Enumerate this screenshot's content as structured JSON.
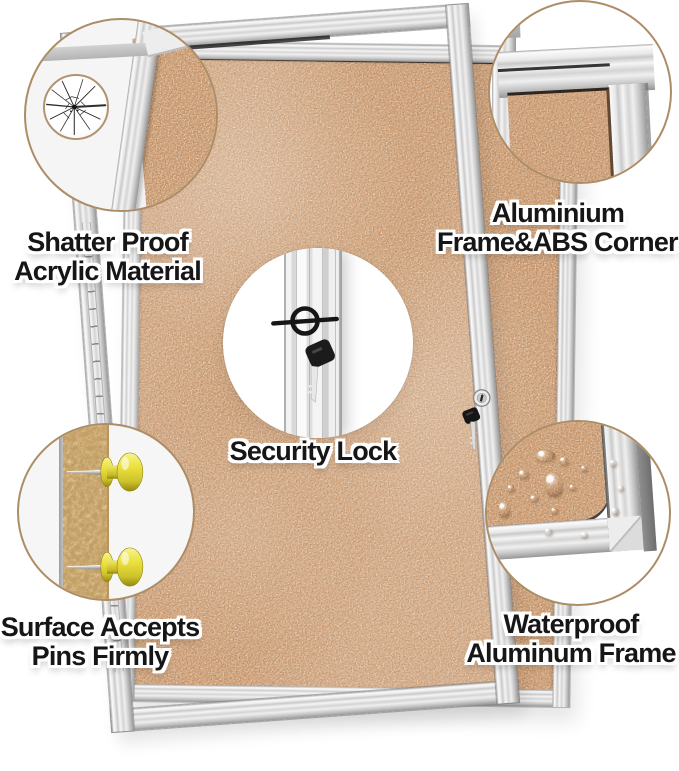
{
  "image_type": "product-feature-callout-diagram",
  "product": "Enclosed cork bulletin board with lockable acrylic door",
  "colors": {
    "background": "#ffffff",
    "cork": "#c28b5e",
    "cork_crumb": "#dab376",
    "frame_silver": "#e9e9e9",
    "circle_ring": "#ac8d65",
    "seam": "#1f1f1f",
    "pin_yellow": "#e9e34a",
    "text": "#161616",
    "text_outline": "#ffffff"
  },
  "callouts": [
    {
      "id": "shatterproof",
      "icon": "cracked-glass",
      "lines": [
        "Shatter Proof",
        "Acrylic Material"
      ]
    },
    {
      "id": "aluminium-corners",
      "icon": "frame-corner",
      "lines": [
        "Aluminium",
        "Frame&ABS Corners"
      ]
    },
    {
      "id": "security-lock",
      "icon": "lock-and-key",
      "lines": [
        "Security Lock"
      ]
    },
    {
      "id": "pins",
      "icon": "push-pins-cross-section",
      "lines": [
        "Surface Accepts",
        "Pins Firmly"
      ]
    },
    {
      "id": "waterproof",
      "icon": "water-drops-on-frame",
      "lines": [
        "Waterproof",
        "Aluminum Frame"
      ]
    }
  ]
}
